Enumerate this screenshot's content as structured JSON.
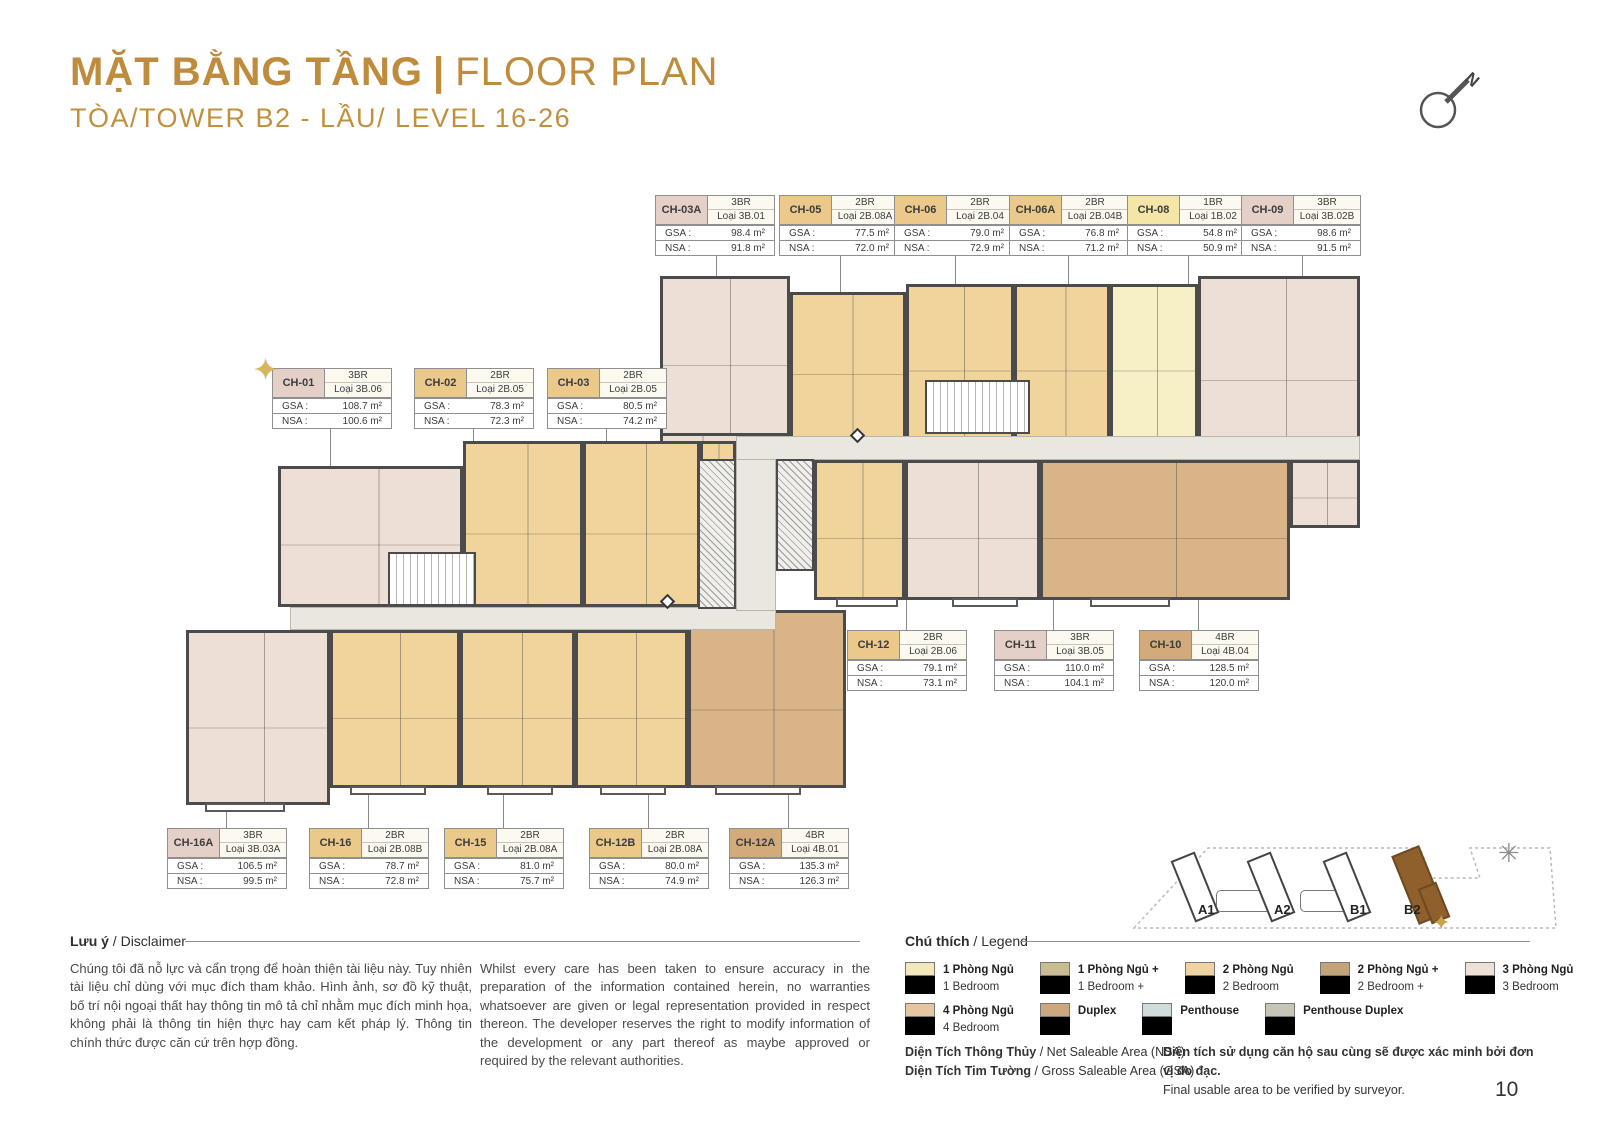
{
  "header": {
    "title_vi": "MẶT BẰNG TẦNG",
    "title_sep": "|",
    "title_en": "FLOOR PLAN",
    "subtitle": "TÒA/TOWER B2 - LẦU/ LEVEL 16-26",
    "accent_color": "#BE8C3C",
    "compass_label": "N"
  },
  "labels": {
    "gsa": "GSA :",
    "nsa": "NSA :"
  },
  "units": [
    {
      "id": "CH-01",
      "br": "3BR",
      "loai": "Loại 3B.06",
      "gsa": "108.7 m²",
      "nsa": "100.6 m²",
      "cat": "3br",
      "star": true
    },
    {
      "id": "CH-02",
      "br": "2BR",
      "loai": "Loại 2B.05",
      "gsa": "78.3 m²",
      "nsa": "72.3 m²",
      "cat": "2br",
      "star": false
    },
    {
      "id": "CH-03",
      "br": "2BR",
      "loai": "Loại 2B.05",
      "gsa": "80.5 m²",
      "nsa": "74.2 m²",
      "cat": "2br",
      "star": false
    },
    {
      "id": "CH-03A",
      "br": "3BR",
      "loai": "Loại 3B.01",
      "gsa": "98.4 m²",
      "nsa": "91.8 m²",
      "cat": "3br",
      "star": false
    },
    {
      "id": "CH-05",
      "br": "2BR",
      "loai": "Loại 2B.08A",
      "gsa": "77.5 m²",
      "nsa": "72.0 m²",
      "cat": "2br",
      "star": false
    },
    {
      "id": "CH-06",
      "br": "2BR",
      "loai": "Loại 2B.04",
      "gsa": "79.0 m²",
      "nsa": "72.9 m²",
      "cat": "2br",
      "star": false
    },
    {
      "id": "CH-06A",
      "br": "2BR",
      "loai": "Loại 2B.04B",
      "gsa": "76.8 m²",
      "nsa": "71.2 m²",
      "cat": "2br",
      "star": false
    },
    {
      "id": "CH-08",
      "br": "1BR",
      "loai": "Loại 1B.02",
      "gsa": "54.8 m²",
      "nsa": "50.9 m²",
      "cat": "1br",
      "star": false
    },
    {
      "id": "CH-09",
      "br": "3BR",
      "loai": "Loại 3B.02B",
      "gsa": "98.6 m²",
      "nsa": "91.5 m²",
      "cat": "3br",
      "star": false
    },
    {
      "id": "CH-12",
      "br": "2BR",
      "loai": "Loại 2B.06",
      "gsa": "79.1 m²",
      "nsa": "73.1 m²",
      "cat": "2br",
      "star": false
    },
    {
      "id": "CH-11",
      "br": "3BR",
      "loai": "Loại 3B.05",
      "gsa": "110.0 m²",
      "nsa": "104.1 m²",
      "cat": "3br",
      "star": false
    },
    {
      "id": "CH-10",
      "br": "4BR",
      "loai": "Loại 4B.04",
      "gsa": "128.5 m²",
      "nsa": "120.0 m²",
      "cat": "4br",
      "star": false
    },
    {
      "id": "CH-16A",
      "br": "3BR",
      "loai": "Loại 3B.03A",
      "gsa": "106.5 m²",
      "nsa": "99.5 m²",
      "cat": "3br",
      "star": false
    },
    {
      "id": "CH-16",
      "br": "2BR",
      "loai": "Loại 2B.08B",
      "gsa": "78.7 m²",
      "nsa": "72.8 m²",
      "cat": "2br",
      "star": false
    },
    {
      "id": "CH-15",
      "br": "2BR",
      "loai": "Loại 2B.08A",
      "gsa": "81.0 m²",
      "nsa": "75.7 m²",
      "cat": "2br",
      "star": false
    },
    {
      "id": "CH-12B",
      "br": "2BR",
      "loai": "Loại 2B.08A",
      "gsa": "80.0 m²",
      "nsa": "74.9 m²",
      "cat": "2br",
      "star": false
    },
    {
      "id": "CH-12A",
      "br": "4BR",
      "loai": "Loại 4B.01",
      "gsa": "135.3 m²",
      "nsa": "126.3 m²",
      "cat": "4br",
      "star": false
    }
  ],
  "disclaimer": {
    "heading_vi": "Lưu ý",
    "heading_en": " / Disclaimer",
    "text_vi": "Chúng tôi đã nỗ lực và cẩn trọng để hoàn thiện tài liệu này. Tuy nhiên tài liệu chỉ dùng với mục đích tham khảo. Hình ảnh, sơ đồ kỹ thuật, bố trí nội ngoại thất hay thông tin mô tả chỉ nhằm mục đích minh họa, không phải là thông tin hiện thực hay cam kết pháp lý. Thông tin chính thức được căn cứ trên hợp đồng.",
    "text_en": "Whilst every care has been taken to ensure accuracy in the preparation of the information contained herein, no warranties whatsoever are given or legal representation provided in respect thereon. The developer reserves the right to modify information of the development or any part thereof as maybe approved or required by the relevant authorities."
  },
  "legend": {
    "heading_vi": "Chú thích",
    "heading_en": " / Legend",
    "items": [
      {
        "vi": "1 Phòng Ngủ",
        "en": "1 Bedroom",
        "color": "#F2E8BC"
      },
      {
        "vi": "1 Phòng Ngủ +",
        "en": "1 Bedroom +",
        "color": "#C8BC90"
      },
      {
        "vi": "2 Phòng Ngủ",
        "en": "2 Bedroom",
        "color": "#EDD4A0"
      },
      {
        "vi": "2 Phòng Ngủ +",
        "en": "2 Bedroom +",
        "color": "#C2A478"
      },
      {
        "vi": "3 Phòng Ngủ",
        "en": "3 Bedroom",
        "color": "#EFE0D6"
      },
      {
        "vi": "4 Phòng Ngủ",
        "en": "4 Bedroom",
        "color": "#E5C69E"
      },
      {
        "vi": "Duplex",
        "en": "",
        "color": "#CDA87E"
      },
      {
        "vi": "Penthouse",
        "en": "",
        "color": "#CEDCDE"
      },
      {
        "vi": "Penthouse Duplex",
        "en": "",
        "color": "#C8C5B6"
      }
    ]
  },
  "area_notes": {
    "nsa_vi": "Diện Tích Thông Thủy",
    "nsa_en": " / Net Saleable Area (NSA)",
    "gsa_vi": "Diện Tích Tim Tường",
    "gsa_en": " / Gross Saleable Area (GSA)",
    "note_vi": "Diện tích sử dụng căn hộ sau cùng sẽ được xác minh bởi đơn vị đo đạc.",
    "note_en": "Final usable area to be verified by surveyor."
  },
  "site_map": {
    "towers": [
      "A1",
      "A2",
      "B1",
      "B2"
    ],
    "highlighted": "B2"
  },
  "page_number": "10"
}
